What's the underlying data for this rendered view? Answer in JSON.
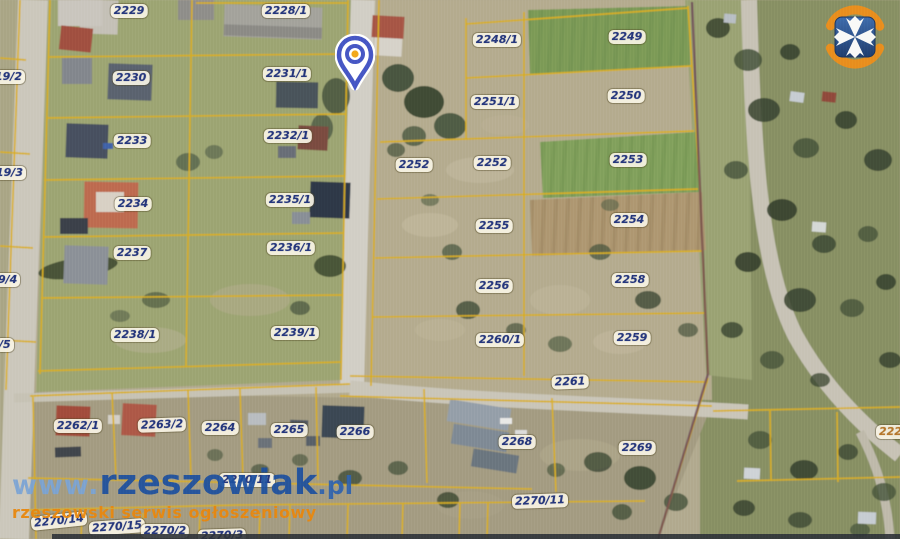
{
  "map": {
    "description": "Satellite cadastral parcel map",
    "boundary_color": "#d9ae1e",
    "label_text_color": "#25367b",
    "label_bg_color": "#f8f4e5",
    "parcel_labels": [
      {
        "text": "2229",
        "x": 129,
        "y": 11
      },
      {
        "text": "2228/1",
        "x": 286,
        "y": 11
      },
      {
        "text": "2248/1",
        "x": 497,
        "y": 40
      },
      {
        "text": "2249",
        "x": 627,
        "y": 37
      },
      {
        "text": "2230",
        "x": 131,
        "y": 78
      },
      {
        "text": "2231/1",
        "x": 287,
        "y": 74
      },
      {
        "text": "2251/1",
        "x": 495,
        "y": 102
      },
      {
        "text": "2250",
        "x": 626,
        "y": 96
      },
      {
        "text": "2233",
        "x": 132,
        "y": 141
      },
      {
        "text": "2232/1",
        "x": 288,
        "y": 136
      },
      {
        "text": "2252",
        "x": 414,
        "y": 165
      },
      {
        "text": "2252",
        "x": 492,
        "y": 163
      },
      {
        "text": "2253",
        "x": 628,
        "y": 160
      },
      {
        "text": "2234",
        "x": 133,
        "y": 204
      },
      {
        "text": "2235/1",
        "x": 290,
        "y": 200
      },
      {
        "text": "2255",
        "x": 494,
        "y": 226
      },
      {
        "text": "2254",
        "x": 629,
        "y": 220
      },
      {
        "text": "2237",
        "x": 132,
        "y": 253
      },
      {
        "text": "2236/1",
        "x": 291,
        "y": 248
      },
      {
        "text": "2256",
        "x": 494,
        "y": 286
      },
      {
        "text": "2258",
        "x": 630,
        "y": 280
      },
      {
        "text": "2238/1",
        "x": 135,
        "y": 335
      },
      {
        "text": "2239/1",
        "x": 295,
        "y": 333
      },
      {
        "text": "2260/1",
        "x": 500,
        "y": 340
      },
      {
        "text": "2259",
        "x": 632,
        "y": 338
      },
      {
        "text": "2261",
        "x": 570,
        "y": 382,
        "rot": -2
      },
      {
        "text": "2262/1",
        "x": 78,
        "y": 426
      },
      {
        "text": "2263/2",
        "x": 162,
        "y": 425,
        "rot": -2
      },
      {
        "text": "2264",
        "x": 220,
        "y": 428
      },
      {
        "text": "2265",
        "x": 289,
        "y": 430
      },
      {
        "text": "2266",
        "x": 355,
        "y": 432
      },
      {
        "text": "2268",
        "x": 517,
        "y": 442
      },
      {
        "text": "2269",
        "x": 637,
        "y": 448
      },
      {
        "text": "2270/11",
        "x": 247,
        "y": 480
      },
      {
        "text": "2270/11",
        "x": 540,
        "y": 501,
        "rot": -2
      },
      {
        "text": "2270/14",
        "x": 59,
        "y": 521,
        "rot": -6
      },
      {
        "text": "2270/15",
        "x": 117,
        "y": 527,
        "rot": -4
      },
      {
        "text": "2270/2",
        "x": 165,
        "y": 531
      },
      {
        "text": "2270/3",
        "x": 222,
        "y": 536,
        "rot": -2
      },
      {
        "text": "19/2",
        "x": -8,
        "y": 77,
        "variant": "edge-left"
      },
      {
        "text": "19/3",
        "x": -7,
        "y": 173,
        "variant": "edge-left"
      },
      {
        "text": "9/4",
        "x": -5,
        "y": 280,
        "variant": "edge-left"
      },
      {
        "text": "/5",
        "x": -4,
        "y": 345,
        "variant": "edge-left"
      },
      {
        "text": "222",
        "x": 876,
        "y": 432,
        "variant": "edge-right"
      }
    ],
    "marker": {
      "type": "location-pin",
      "x": 355,
      "y": 62,
      "ring_color": "#4656c4",
      "dot_color": "#f2a71b"
    },
    "logo": {
      "name": "rzeszow-coat-of-arms",
      "square_color": "#2b4f8e",
      "cross_color": "#ffffff",
      "ring_color": "#ee8d1b"
    },
    "watermark": {
      "prefix": "www.",
      "domain": "rzeszowiak",
      "tld": ".pl",
      "tagline": "rzeszowski serwis ogłoszeniowy",
      "domain_color": "#1d4f9e",
      "tagline_color": "#e8860f"
    }
  }
}
